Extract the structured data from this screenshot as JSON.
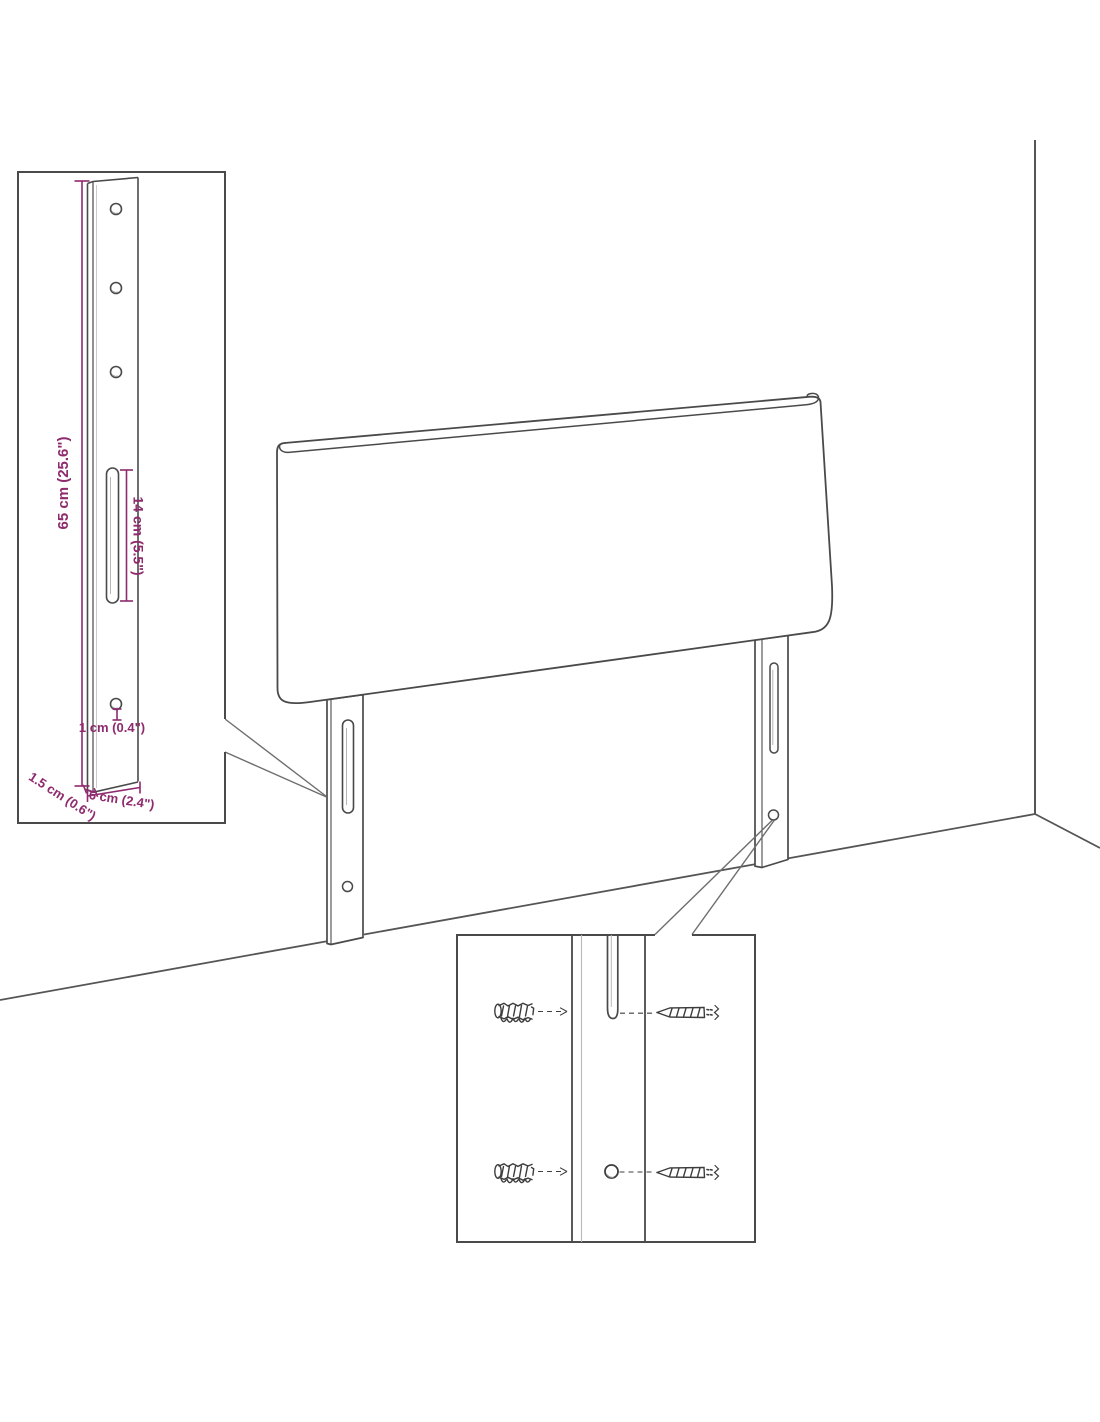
{
  "diagram": {
    "accent_color": "#8e2a6d",
    "line_color": "#4a4a4a",
    "labels": {
      "bracket_height": "65 cm (25.6\")",
      "slot_length": "14 cm (5.5\")",
      "hole_offset": "1 cm (0.4\")",
      "bracket_depth": "1.5 cm (0.6\")",
      "bracket_width": "6 cm (2.4\")"
    },
    "icons": {
      "wall_plug": "wall-plug-icon",
      "screw": "screw-icon"
    }
  }
}
